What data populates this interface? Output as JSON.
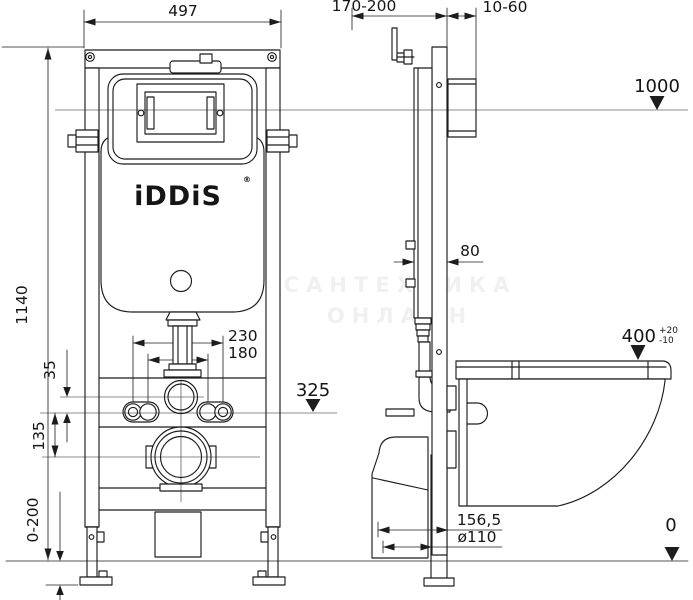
{
  "colors": {
    "line": "#1c1c1c",
    "background": "#ffffff"
  },
  "brand": {
    "name": "iDDiS",
    "registered": "®"
  },
  "watermark": {
    "line1": "САНТЕХНИКА",
    "line2": "ОНЛАЙН"
  },
  "dims": {
    "front_width": "497",
    "depth_range": "170-200",
    "wall_gap": "10-60",
    "level_1000": "1000",
    "frame_height": "1140",
    "stud_outer": "230",
    "stud_inner": "180",
    "offset_35": "35",
    "offset_135": "135",
    "level_325": "325",
    "profile_depth": "80",
    "seat_height": "400",
    "seat_tol_plus": "+20",
    "seat_tol_minus": "-10",
    "drain_offset": "156,5",
    "drain_diameter": "ø110",
    "foot_adjust": "0-200",
    "floor_level": "0"
  }
}
